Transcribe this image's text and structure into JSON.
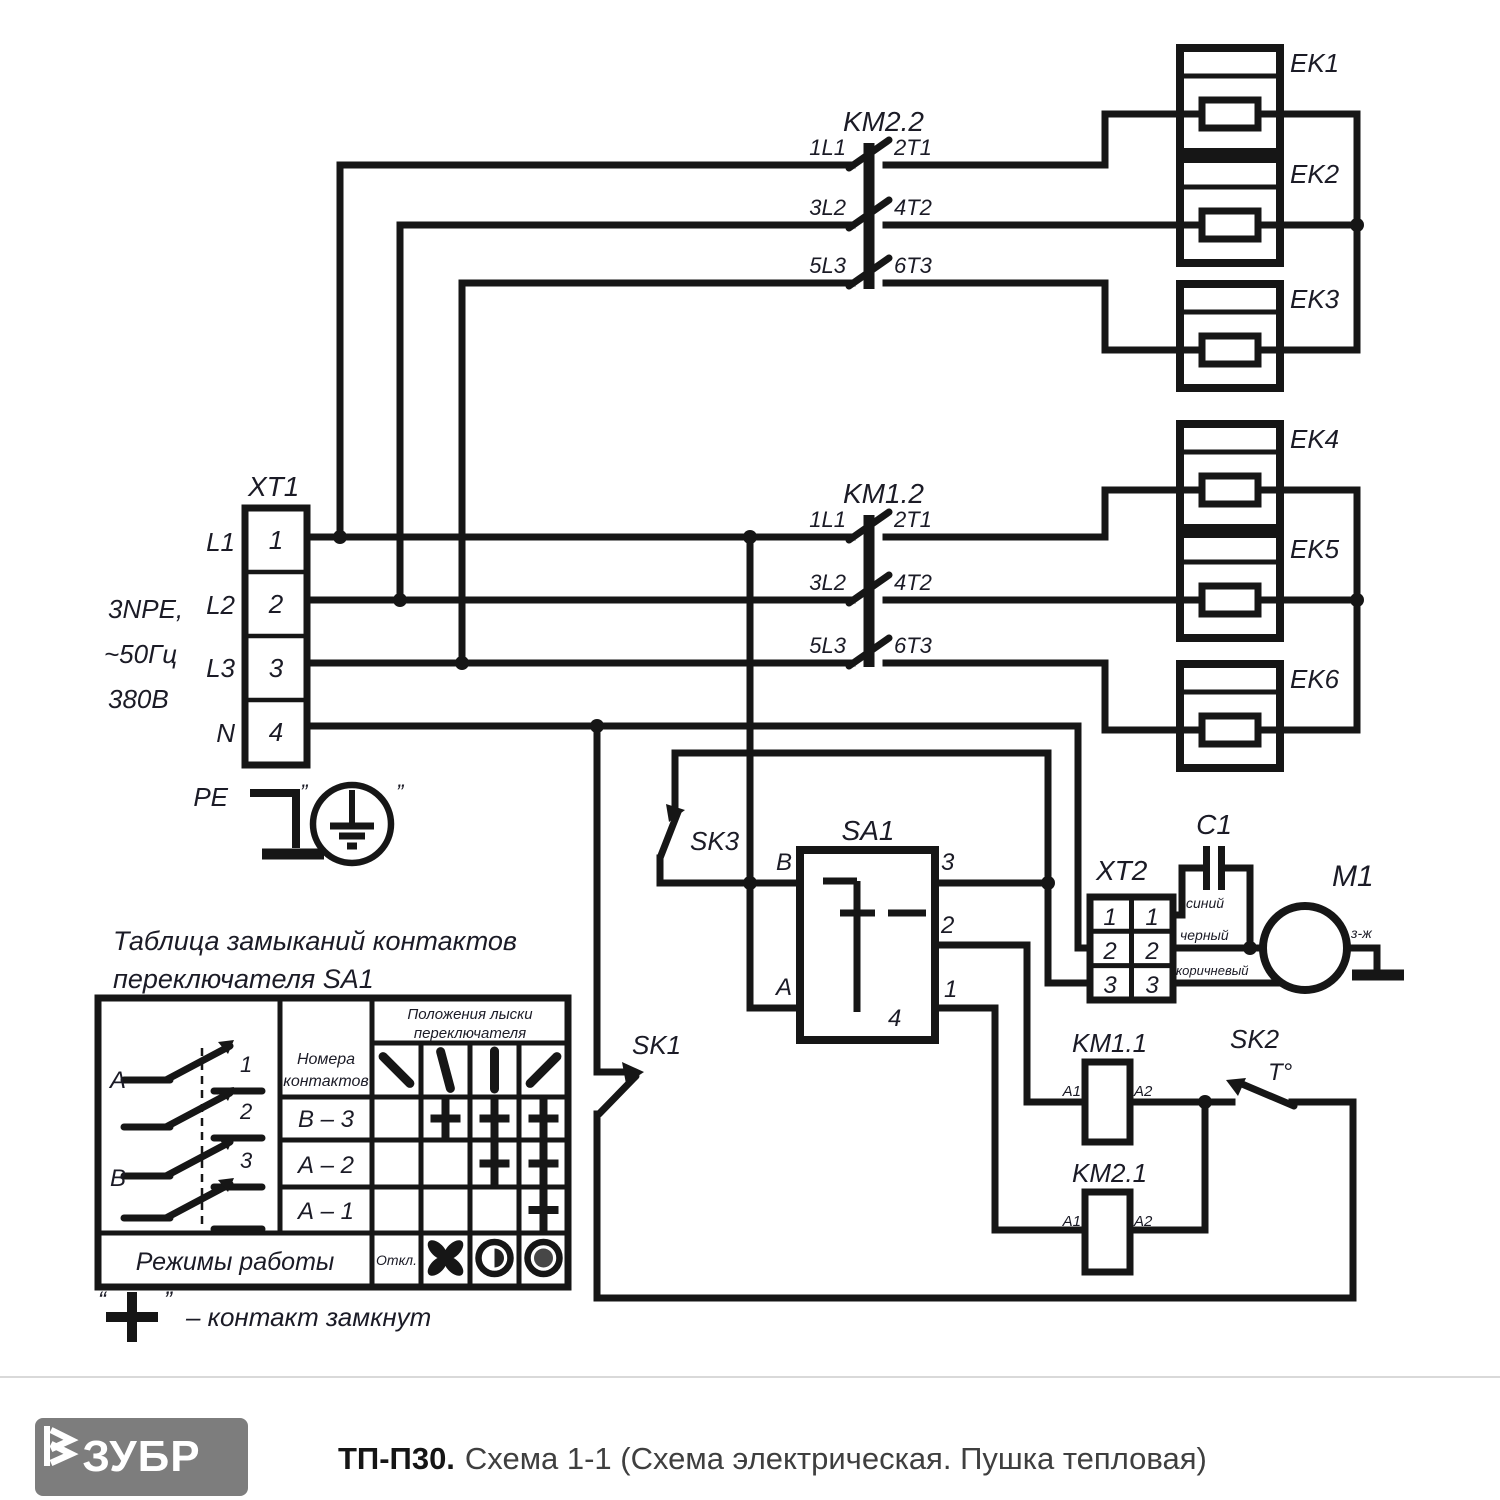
{
  "diagram": {
    "xt1": {
      "name": "XT1",
      "terminals": [
        "1",
        "2",
        "3",
        "4"
      ],
      "lines": [
        "L1",
        "L2",
        "L3",
        "N"
      ],
      "supply": [
        "3NPE,",
        "~50Гц",
        "380В"
      ],
      "pe_label": "PE",
      "pe_quote_left": "”",
      "pe_quote_right": "”"
    },
    "km22": {
      "name": "KM2.2",
      "poles": [
        {
          "in": "1L1",
          "out": "2T1"
        },
        {
          "in": "3L2",
          "out": "4T2"
        },
        {
          "in": "5L3",
          "out": "6T3"
        }
      ]
    },
    "km12": {
      "name": "KM1.2",
      "poles": [
        {
          "in": "1L1",
          "out": "2T1"
        },
        {
          "in": "3L2",
          "out": "4T2"
        },
        {
          "in": "5L3",
          "out": "6T3"
        }
      ]
    },
    "heaters": [
      "EK1",
      "EK2",
      "EK3",
      "EK4",
      "EK5",
      "EK6"
    ],
    "sa1": {
      "name": "SA1",
      "pin_b": "B",
      "pin_a": "A",
      "pin3": "3",
      "pin2": "2",
      "pin1": "1",
      "pin4": "4"
    },
    "sk1": {
      "name": "SK1"
    },
    "sk2": {
      "name": "SK2",
      "temp": "Т°"
    },
    "sk3": {
      "name": "SK3"
    },
    "xt2": {
      "name": "XT2",
      "left_pins": [
        "1",
        "2",
        "3"
      ],
      "right_pins": [
        "1",
        "2",
        "3"
      ],
      "wire_colors": [
        "синий",
        "черный",
        "коричневый"
      ]
    },
    "c1": {
      "name": "C1"
    },
    "m1": {
      "name": "M1",
      "ground_wire": "з-ж"
    },
    "km11": {
      "name": "KM1.1",
      "a1": "A1",
      "a2": "A2"
    },
    "km21": {
      "name": "KM2.1",
      "a1": "A1",
      "a2": "A2"
    }
  },
  "table": {
    "title_line1": "Таблица замыканий контактов",
    "title_line2": "переключателя SA1",
    "contacts_header_line1": "Номера",
    "contacts_header_line2": "контактов",
    "positions_header_line1": "Положения лыски",
    "positions_header_line2": "переключателя",
    "rows": [
      {
        "label": "В – 3",
        "closed_positions": [
          2,
          3,
          4
        ]
      },
      {
        "label": "А – 2",
        "closed_positions": [
          3,
          4
        ]
      },
      {
        "label": "А – 1",
        "closed_positions": [
          4
        ]
      }
    ],
    "modes_label": "Режимы работы",
    "off_label": "Откл.",
    "pole_group_a": "А",
    "pole_group_b": "В",
    "pole_numbers": [
      "1",
      "2",
      "3"
    ],
    "footnote_quote_open": "“",
    "footnote_quote_close": "”",
    "footnote_text": "– контакт замкнут"
  },
  "footer": {
    "brand": "ЗУБР",
    "model": "ТП-П30.",
    "subtitle": "Схема 1-1 (Схема электрическая. Пушка тепловая)"
  }
}
